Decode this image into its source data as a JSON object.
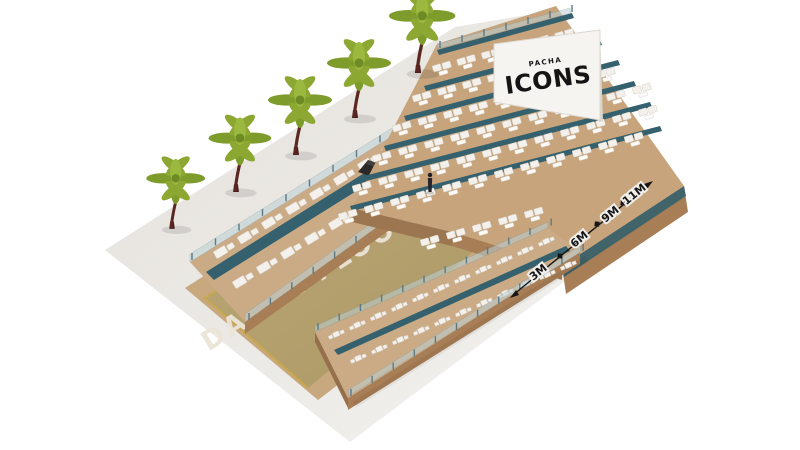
{
  "scene": {
    "type": "3d-isometric-venue-seating-plan",
    "dance_floor": {
      "label": "DANCE FLOOR"
    },
    "screen": {
      "brand_top": "PACHA",
      "brand_main": "ICONS"
    },
    "dimension_ruler": {
      "labels": [
        "3M",
        "6M",
        "9M",
        "11M"
      ]
    },
    "landscaping": {
      "palm_tree_count": 5
    },
    "people": {
      "standing_figure_count": 1
    },
    "colors": {
      "background": "#FFFFFF",
      "ground": "#EAE8E4",
      "ground_bright": "#F4F3F1",
      "wood_deck": "#C7A47C",
      "wood_side": "#A87E56",
      "walkway_teal": "#35606D",
      "dance_floor": "#B3A06E",
      "gold_trim": "#C9A84C",
      "sofa_white": "#F4F1EC",
      "glass_railing": "#BCD0D5",
      "palm_green": "#8CA832",
      "palm_trunk": "#5C2621",
      "screen_white": "#F6F4F1",
      "booth_dark": "#2B2A28",
      "ink": "#161616"
    }
  }
}
